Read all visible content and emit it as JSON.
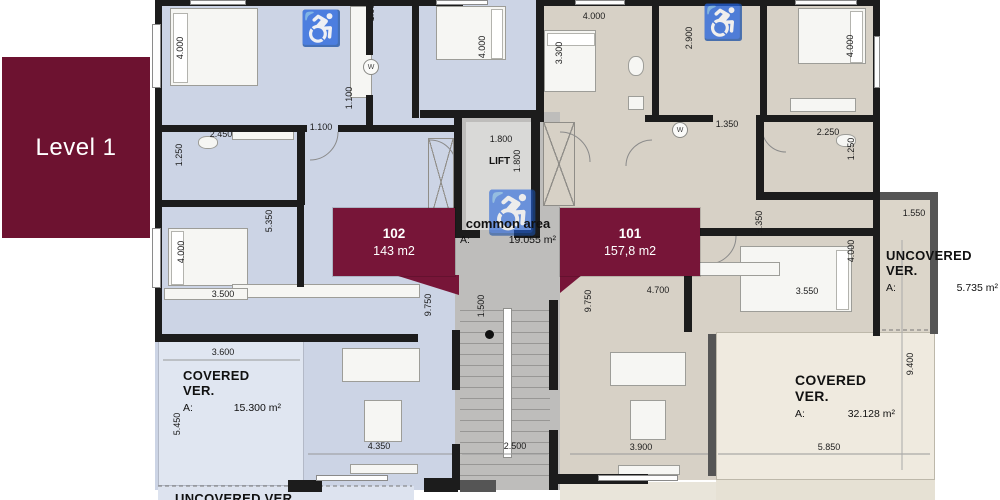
{
  "level_badge": {
    "label": "Level 1"
  },
  "units": {
    "u102": {
      "number": "102",
      "area": "143 m2"
    },
    "u101": {
      "number": "101",
      "area": "157,8 m2"
    },
    "common": {
      "name": "common area",
      "prefix": "A:",
      "area": "19.055 m²"
    },
    "lift_label": "LIFT"
  },
  "verandas": {
    "covered_left": {
      "name": "COVERED VER.",
      "prefix": "A:",
      "area": "15.300 m²"
    },
    "covered_right": {
      "name": "COVERED VER.",
      "prefix": "A:",
      "area": "32.128 m²"
    },
    "uncovered_right": {
      "name": "UNCOVERED VER.",
      "prefix": "A:",
      "area": "5.735 m²"
    },
    "uncovered_bottom_left": {
      "name": "UNCOVERED VER."
    }
  },
  "icons": {
    "accessible": "♿",
    "washer": "W"
  },
  "dimensions": [
    {
      "t": "4.000",
      "x": 180,
      "y": 48,
      "v": true
    },
    {
      "t": "1.000",
      "x": 371,
      "y": 10,
      "v": true
    },
    {
      "t": "4.000",
      "x": 482,
      "y": 47,
      "v": true
    },
    {
      "t": "2.450",
      "x": 221,
      "y": 134
    },
    {
      "t": "1.100",
      "x": 321,
      "y": 127
    },
    {
      "t": "1.100",
      "x": 349,
      "y": 98,
      "v": true
    },
    {
      "t": "1.250",
      "x": 179,
      "y": 155,
      "v": true
    },
    {
      "t": "5.350",
      "x": 269,
      "y": 221,
      "v": true
    },
    {
      "t": "4.000",
      "x": 181,
      "y": 252,
      "v": true
    },
    {
      "t": "3.500",
      "x": 223,
      "y": 294
    },
    {
      "t": "9.750",
      "x": 428,
      "y": 305,
      "v": true
    },
    {
      "t": "3.600",
      "x": 223,
      "y": 352
    },
    {
      "t": "5.450",
      "x": 177,
      "y": 424,
      "v": true
    },
    {
      "t": "4.350",
      "x": 379,
      "y": 446
    },
    {
      "t": "1.800",
      "x": 501,
      "y": 139
    },
    {
      "t": "1.800",
      "x": 517,
      "y": 161,
      "v": true
    },
    {
      "t": "1.500",
      "x": 481,
      "y": 306,
      "v": true
    },
    {
      "t": "2.500",
      "x": 515,
      "y": 446
    },
    {
      "t": "4.000",
      "x": 594,
      "y": 16
    },
    {
      "t": "3.300",
      "x": 559,
      "y": 53,
      "v": true
    },
    {
      "t": "2.900",
      "x": 689,
      "y": 38,
      "v": true
    },
    {
      "t": "1.350",
      "x": 727,
      "y": 124
    },
    {
      "t": "2.250",
      "x": 828,
      "y": 132
    },
    {
      "t": "1.250",
      "x": 851,
      "y": 149,
      "v": true
    },
    {
      "t": "4.000",
      "x": 850,
      "y": 46,
      "v": true
    },
    {
      "t": "5.350",
      "x": 759,
      "y": 222,
      "v": true
    },
    {
      "t": "9.750",
      "x": 588,
      "y": 301,
      "v": true
    },
    {
      "t": "4.700",
      "x": 658,
      "y": 290
    },
    {
      "t": "3.550",
      "x": 807,
      "y": 291
    },
    {
      "t": "4.000",
      "x": 851,
      "y": 251,
      "v": true
    },
    {
      "t": "3.900",
      "x": 641,
      "y": 447
    },
    {
      "t": "5.850",
      "x": 829,
      "y": 447
    },
    {
      "t": "9.400",
      "x": 910,
      "y": 364,
      "v": true
    },
    {
      "t": "1.550",
      "x": 914,
      "y": 213
    }
  ],
  "colors": {
    "badge_maroon": "#6d1230",
    "label_maroon": "#771538",
    "blue_fill": "#ccd4e5",
    "blue_light": "#e0e6f1",
    "beige_fill": "#d7d1c6",
    "beige_light": "#efeadf",
    "beige_mid": "#dcd6ca",
    "gray_fill": "#bebdbb",
    "gray_light": "#d9d9d7",
    "wall": "#1c1c1c",
    "text": "#1e1e1e"
  }
}
